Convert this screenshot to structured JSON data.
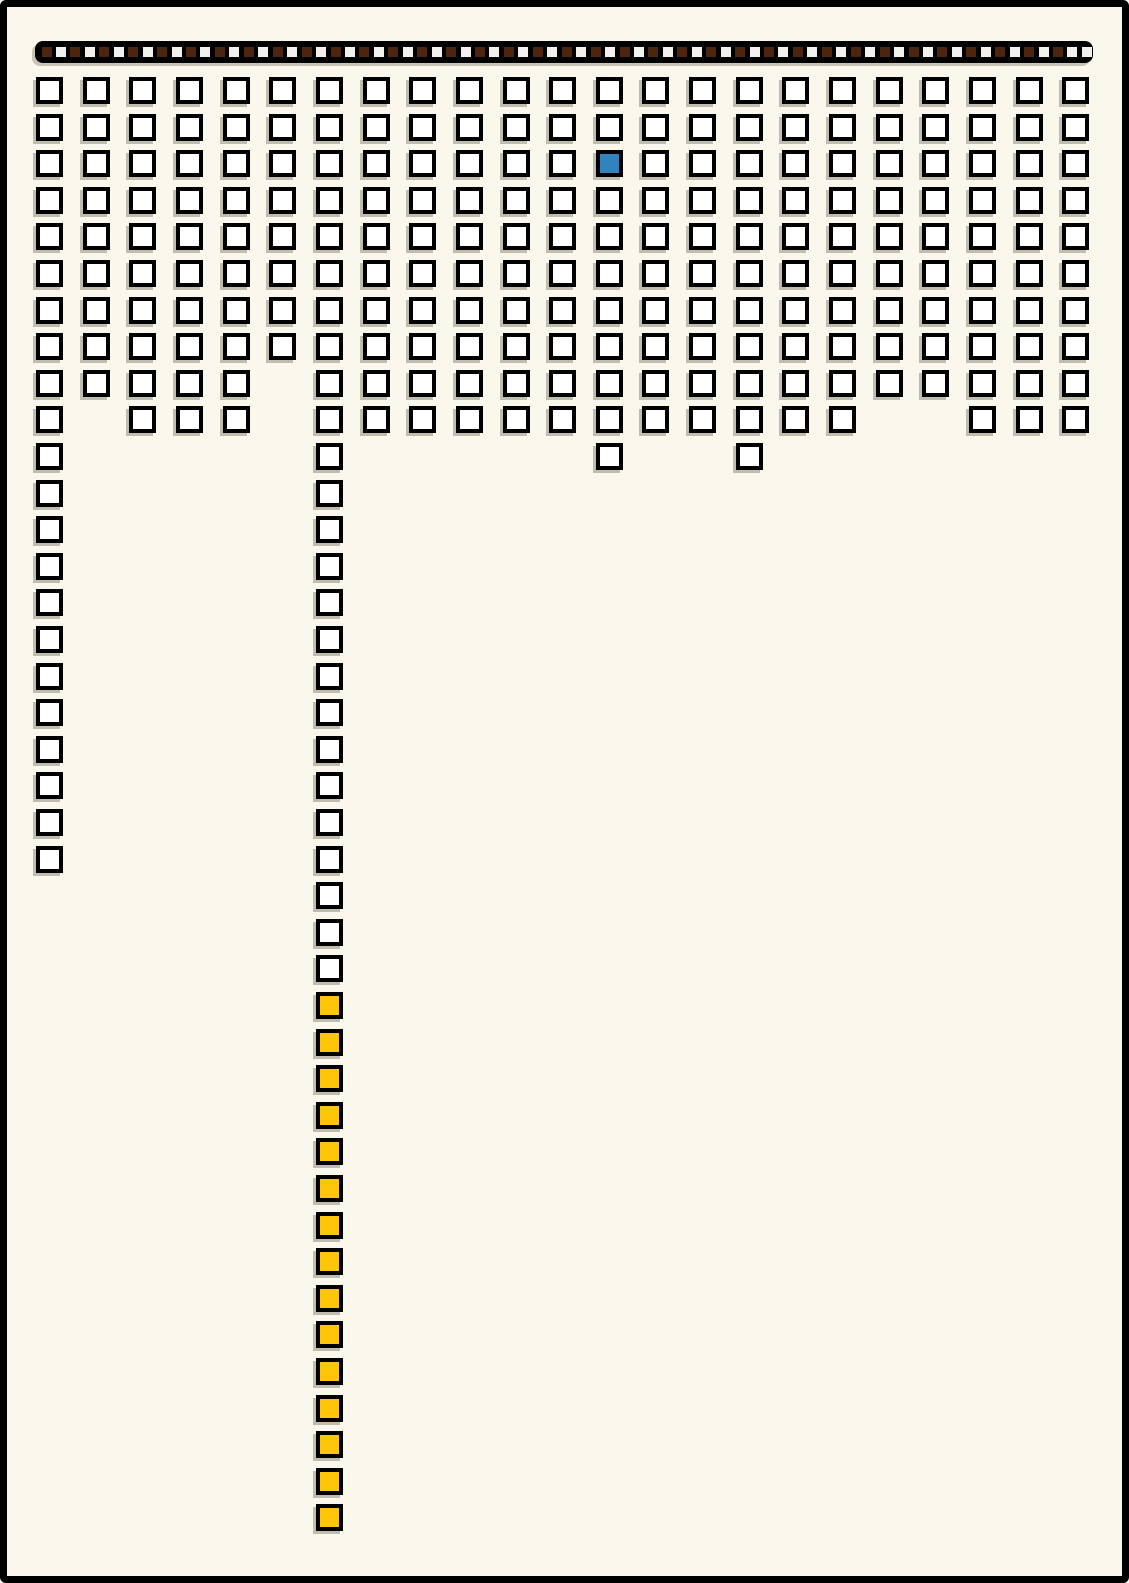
{
  "page": {
    "background_color": "#FAF8EC",
    "frame_border_color": "#000000"
  },
  "header_strip": {
    "bar_color": "#000000",
    "unit_dark_color": "#4C250F",
    "unit_light_color": "#F1F0EC",
    "unit_count": 73,
    "units_pattern": "DLDLDLDLDLDLDLDLDLDLDLDLDLDLDLDLDLDLDLDLDLDLDLDLDLDLDLDLDLDLDLDLDLDLDLDLL"
  },
  "grid": {
    "cell_fill_color": "#FFFFFF",
    "cell_border_color": "#000000",
    "highlight_blue_color": "#3182BD",
    "highlight_yellow_color": "#FDC608",
    "columns": [
      {
        "white": 22,
        "yellow": 0,
        "blue_row": 0
      },
      {
        "white": 9,
        "yellow": 0,
        "blue_row": 0
      },
      {
        "white": 10,
        "yellow": 0,
        "blue_row": 0
      },
      {
        "white": 10,
        "yellow": 0,
        "blue_row": 0
      },
      {
        "white": 10,
        "yellow": 0,
        "blue_row": 0
      },
      {
        "white": 8,
        "yellow": 0,
        "blue_row": 0
      },
      {
        "white": 25,
        "yellow": 15,
        "blue_row": 0
      },
      {
        "white": 10,
        "yellow": 0,
        "blue_row": 0
      },
      {
        "white": 10,
        "yellow": 0,
        "blue_row": 0
      },
      {
        "white": 10,
        "yellow": 0,
        "blue_row": 0
      },
      {
        "white": 10,
        "yellow": 0,
        "blue_row": 0
      },
      {
        "white": 10,
        "yellow": 0,
        "blue_row": 0
      },
      {
        "white": 11,
        "yellow": 0,
        "blue_row": 3
      },
      {
        "white": 10,
        "yellow": 0,
        "blue_row": 0
      },
      {
        "white": 10,
        "yellow": 0,
        "blue_row": 0
      },
      {
        "white": 11,
        "yellow": 0,
        "blue_row": 0
      },
      {
        "white": 10,
        "yellow": 0,
        "blue_row": 0
      },
      {
        "white": 10,
        "yellow": 0,
        "blue_row": 0
      },
      {
        "white": 9,
        "yellow": 0,
        "blue_row": 0
      },
      {
        "white": 9,
        "yellow": 0,
        "blue_row": 0
      },
      {
        "white": 10,
        "yellow": 0,
        "blue_row": 0
      },
      {
        "white": 10,
        "yellow": 0,
        "blue_row": 0
      },
      {
        "white": 10,
        "yellow": 0,
        "blue_row": 0
      }
    ]
  },
  "chart_data": {
    "type": "bar",
    "subtype": "unit-square pictograph (waffle columns hanging from top edge)",
    "title": "",
    "xlabel": "",
    "ylabel": "",
    "legend": [],
    "categories": [
      "c1",
      "c2",
      "c3",
      "c4",
      "c5",
      "c6",
      "c7",
      "c8",
      "c9",
      "c10",
      "c11",
      "c12",
      "c13",
      "c14",
      "c15",
      "c16",
      "c17",
      "c18",
      "c19",
      "c20",
      "c21",
      "c22",
      "c23"
    ],
    "values_total_units": [
      22,
      9,
      10,
      10,
      10,
      8,
      40,
      10,
      10,
      10,
      10,
      10,
      11,
      10,
      10,
      11,
      10,
      10,
      9,
      9,
      10,
      10,
      10
    ],
    "series": [
      {
        "name": "white-units",
        "values": [
          22,
          9,
          10,
          10,
          10,
          8,
          25,
          10,
          10,
          10,
          10,
          10,
          11,
          10,
          10,
          11,
          10,
          10,
          9,
          9,
          10,
          10,
          10
        ]
      },
      {
        "name": "yellow-units",
        "values": [
          0,
          0,
          0,
          0,
          0,
          0,
          15,
          0,
          0,
          0,
          0,
          0,
          0,
          0,
          0,
          0,
          0,
          0,
          0,
          0,
          0,
          0,
          0
        ]
      }
    ],
    "highlights": {
      "blue_unit": {
        "column": 13,
        "row": 3,
        "color": "#3182BD"
      },
      "yellow_run": {
        "column": 7,
        "row_start": 26,
        "row_end": 40,
        "count": 15,
        "color": "#FDC608"
      }
    },
    "header_strip": {
      "total_small_units": 73,
      "dark_units": 36,
      "light_units": 37,
      "pattern": "alternating dark-brown/white starting dark; final two units white",
      "dark_color": "#4C250F",
      "light_color": "#F1F0EC"
    },
    "layout_hints": {
      "columns_start_x": 36,
      "column_pitch": 46.65,
      "rows_start_y": 77,
      "row_pitch": 36.6,
      "unit_outer_size": 27,
      "grid_off": true,
      "legend_position": "none"
    }
  }
}
